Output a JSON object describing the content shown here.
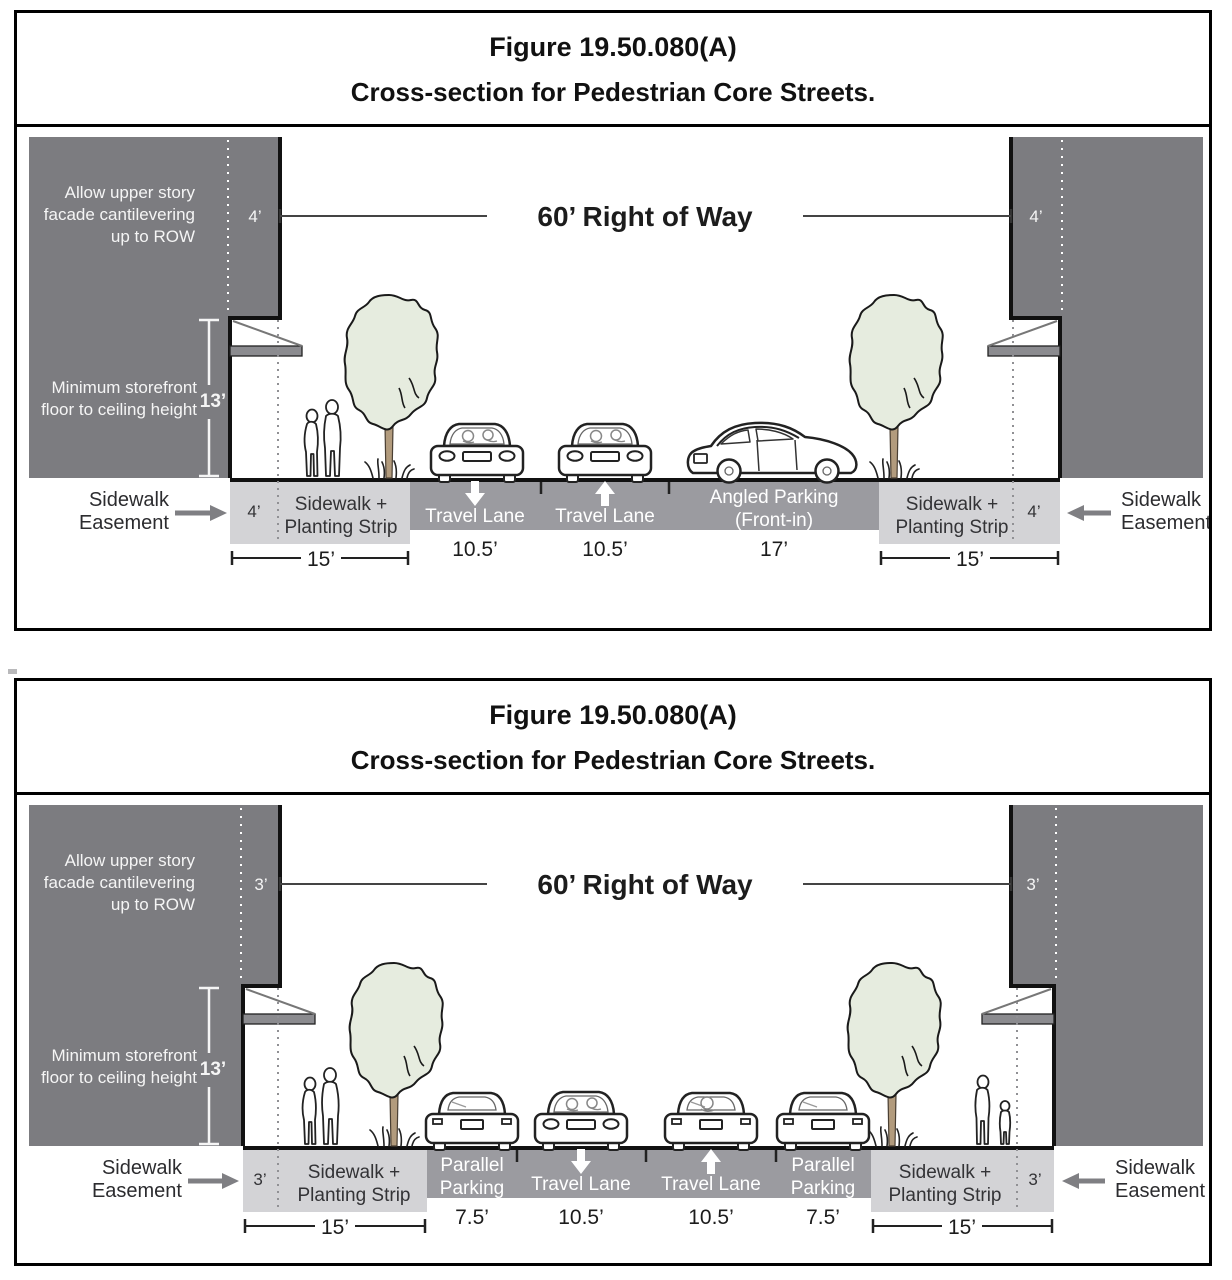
{
  "colors": {
    "building": "#7c7c80",
    "road": "#9b9ba0",
    "slab": "#d3d3d6",
    "awning": "#8b8b8f",
    "foliage": "#e6ecdf",
    "trunk": "#b29b7d",
    "arrow_gray": "#7f7f83",
    "line_black": "#1a1a1a",
    "white": "#ffffff"
  },
  "panels": [
    {
      "title_line1": "Figure 19.50.080(A)",
      "title_line2": "Cross-section for Pedestrian Core Streets.",
      "right_of_way": "60’ Right of Way",
      "cantilever_note_lines": [
        "Allow upper story",
        "facade cantilevering",
        "up to ROW"
      ],
      "storefront_note_lines": [
        "Minimum storefront",
        "floor to ceiling height"
      ],
      "storefront_height": "13’",
      "cantilever_setback_left": "4’",
      "cantilever_setback_right": "4’",
      "easement_label_lines": [
        "Sidewalk",
        "Easement"
      ],
      "left_sidewalk": {
        "easement_width": "4’",
        "label_lines": [
          "Sidewalk +",
          "Planting Strip"
        ],
        "total_width": "15’"
      },
      "right_sidewalk": {
        "easement_width": "4’",
        "label_lines": [
          "Sidewalk +",
          "Planting Strip"
        ],
        "total_width": "15’"
      },
      "lanes": [
        {
          "label_lines": [
            "Travel Lane"
          ],
          "direction": "down",
          "width": "10.5’"
        },
        {
          "label_lines": [
            "Travel Lane"
          ],
          "direction": "up",
          "width": "10.5’"
        },
        {
          "label_lines": [
            "Angled Parking",
            "(Front-in)"
          ],
          "direction": "none",
          "width": "17’"
        }
      ]
    },
    {
      "title_line1": "Figure 19.50.080(A)",
      "title_line2": "Cross-section for Pedestrian Core Streets.",
      "right_of_way": "60’ Right of Way",
      "cantilever_note_lines": [
        "Allow upper story",
        "facade cantilevering",
        "up to ROW"
      ],
      "storefront_note_lines": [
        "Minimum storefront",
        "floor to ceiling height"
      ],
      "storefront_height": "13’",
      "cantilever_setback_left": "3’",
      "cantilever_setback_right": "3’",
      "easement_label_lines": [
        "Sidewalk",
        "Easement"
      ],
      "left_sidewalk": {
        "easement_width": "3’",
        "label_lines": [
          "Sidewalk +",
          "Planting Strip"
        ],
        "total_width": "15’"
      },
      "right_sidewalk": {
        "easement_width": "3’",
        "label_lines": [
          "Sidewalk +",
          "Planting Strip"
        ],
        "total_width": "15’"
      },
      "lanes": [
        {
          "label_lines": [
            "Parallel",
            "Parking"
          ],
          "direction": "none",
          "width": "7.5’"
        },
        {
          "label_lines": [
            "Travel Lane"
          ],
          "direction": "down",
          "width": "10.5’"
        },
        {
          "label_lines": [
            "Travel Lane"
          ],
          "direction": "up",
          "width": "10.5’"
        },
        {
          "label_lines": [
            "Parallel",
            "Parking"
          ],
          "direction": "none",
          "width": "7.5’"
        }
      ]
    }
  ]
}
